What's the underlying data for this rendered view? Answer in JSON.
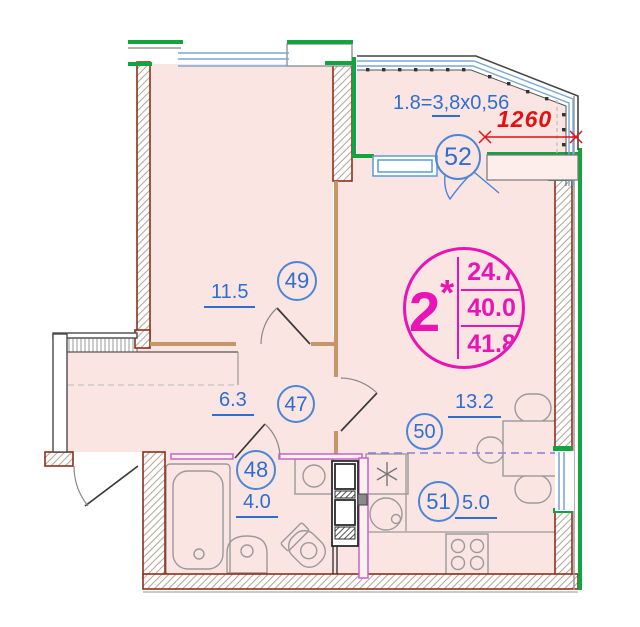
{
  "plan": {
    "title": "apartment floor plan",
    "rooms": {
      "r49": {
        "number": "49",
        "area": "11.5"
      },
      "r47": {
        "number": "47",
        "area": "6.3"
      },
      "r48": {
        "number": "48",
        "area": "4.0"
      },
      "r50": {
        "number": "50",
        "area": "13.2"
      },
      "r51": {
        "number": "51",
        "area": "5.0"
      },
      "r52": {
        "number": "52"
      }
    },
    "summary": {
      "number": "2",
      "star": "*",
      "value_top": "24.7",
      "value_mid": "40.0",
      "value_bottom": "41.8"
    },
    "balcony": {
      "formula_prefix": "1.8=",
      "formula_underlined": "3,8",
      "formula_suffix": "x0,56",
      "dimension": "1260"
    },
    "colors": {
      "wall": "#8e2f1a",
      "exterior_green": "#12a43e",
      "window_blue": "#79a8d8",
      "label_blue": "#2d6ed0",
      "magenta_accent": "#ea14b4",
      "dimension_red": "#e01212",
      "floor_fill": "#fbe5e2",
      "partition_tan": "#c79668",
      "partition_magenta": "#c565c5"
    }
  }
}
